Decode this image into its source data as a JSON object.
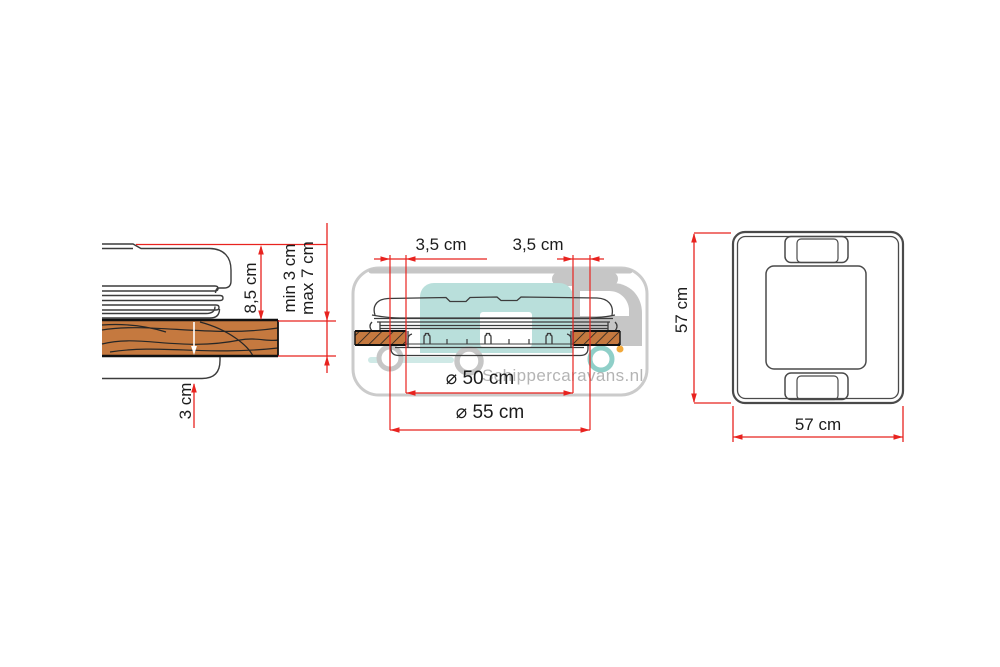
{
  "diagram": {
    "watermark_text": "Schippercaravans.nl",
    "colors": {
      "dimension_red": "#e8231f",
      "wood_fill": "#c5793f",
      "drawing_line": "#3c3c3c",
      "watermark_gray": "#c6c6c6",
      "watermark_teal": "#b9dfdb"
    },
    "side_view": {
      "labels": {
        "vent_height": "8,5 cm",
        "roof_min": "min 3 cm",
        "roof_max": "max 7 cm",
        "roof_thickness": "3 cm"
      }
    },
    "cross_section_view": {
      "labels": {
        "flange_left": "3,5 cm",
        "flange_right": "3,5 cm",
        "cutout_diameter": "⌀ 50 cm",
        "outer_diameter": "⌀ 55 cm"
      }
    },
    "top_view": {
      "labels": {
        "side_height": "57 cm",
        "bottom_width": "57 cm"
      }
    }
  }
}
